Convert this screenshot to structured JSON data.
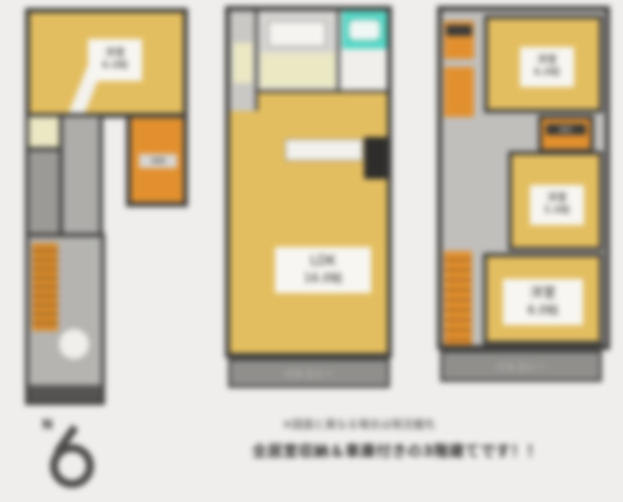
{
  "colors": {
    "background": "#efeeec",
    "wall": "#403f3d",
    "room_yellow": "#e3be60",
    "stair_orange": "#e2902f",
    "bath_teal": "#55d8c6",
    "hall_cream": "#ebe8c4",
    "balcony_gray": "#908f8c"
  },
  "floor1": {
    "bedroom": {
      "name": "洋室",
      "size": "6.0帖"
    },
    "storage_label": "収納"
  },
  "floor2": {
    "ldk": {
      "name": "LDK",
      "size": "16.0帖"
    },
    "balcony_label": "バルコニー"
  },
  "floor3": {
    "bedroom_top": {
      "name": "洋室",
      "size": "6.0帖"
    },
    "closet_label": "WIC",
    "bedroom_mid": {
      "name": "洋室",
      "size": "5.0帖"
    },
    "bedroom_bottom": {
      "name": "洋室",
      "size": "6.0帖"
    },
    "balcony_label": "バルコニー"
  },
  "compass": {
    "letter": "N"
  },
  "caption": {
    "line1": "※図面と異なる場合は現況優先",
    "line2": "全居室収納＆車庫付きの3階建てです！！"
  }
}
